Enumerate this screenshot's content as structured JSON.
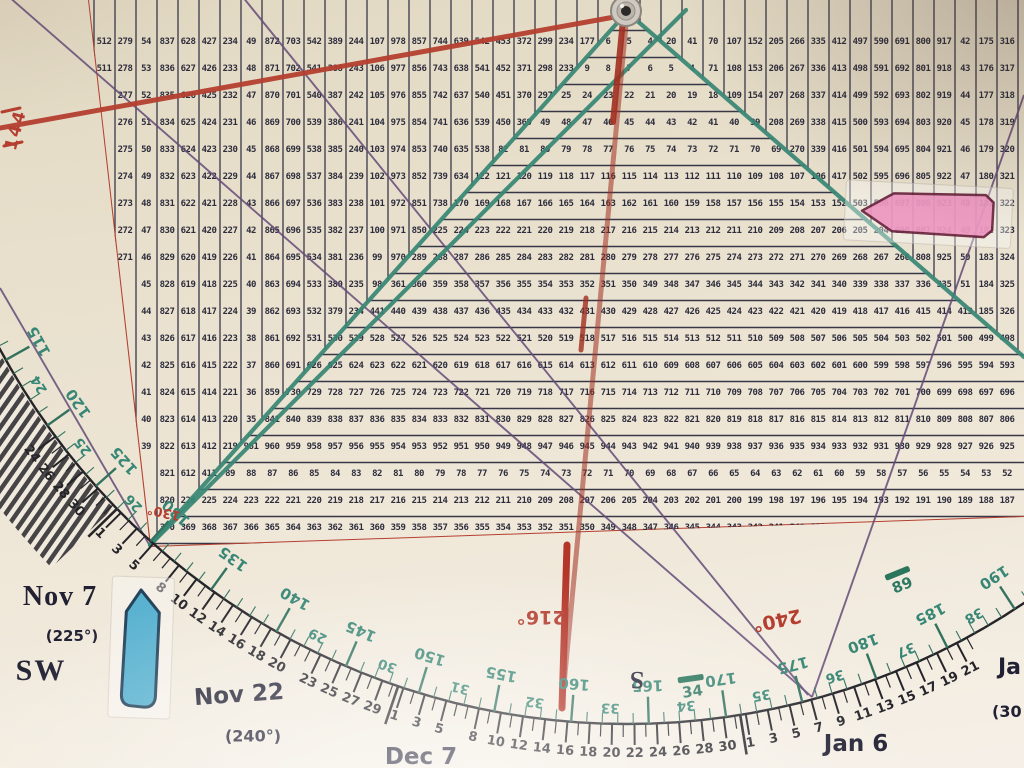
{
  "colors": {
    "ink": "#202134",
    "grid_line": "#2c2c40",
    "red": "#b23526",
    "dark_red": "#9c2316",
    "green": "#2c8170",
    "green_tick": "#256b58",
    "purple": "#5a4173",
    "navy": "#14142a",
    "pink": "#ee8fc0",
    "pink_border": "#5d1230",
    "blue": "#4fb0d2",
    "blue_border": "#173a55",
    "arc_ink": "#17171f"
  },
  "grid": {
    "left_column_tops": [
      512,
      279,
      54,
      837,
      628,
      427,
      234,
      49,
      872,
      703,
      542,
      389,
      244,
      107,
      978,
      857,
      744,
      639,
      542,
      453,
      372,
      299,
      234,
      177,
      128,
      87
    ],
    "right_column_tops": [
      2,
      7,
      20,
      41,
      70,
      107,
      152,
      205,
      266,
      335,
      412,
      497,
      590,
      691,
      800,
      917,
      42,
      175,
      316,
      465
    ],
    "triangle_row_maxes": [
      6,
      10,
      26,
      50,
      82,
      122,
      170,
      226,
      290,
      362,
      442,
      530,
      626,
      730,
      842,
      962,
      90,
      226,
      370,
      522
    ]
  },
  "labels": {
    "nov7": "Nov 7",
    "deg225": "(225°)",
    "sw": "SW",
    "nov22": "Nov 22",
    "deg240": "(240°)",
    "dec7": "Dec 7",
    "jan6": "Jan 6",
    "jan_partial": "Ja",
    "deg300_partial": "(30",
    "south": "S",
    "red_216": "216°",
    "red_240": "240°",
    "red_144": "144",
    "red_130": "130°",
    "marker_34": "34",
    "marker_89": "89"
  },
  "arc": {
    "black_day_labels": [
      [
        -8,
        "24"
      ],
      [
        -6,
        "26"
      ],
      [
        -4,
        "28"
      ],
      [
        -2,
        "30"
      ],
      [
        1,
        "1"
      ],
      [
        3,
        "3"
      ],
      [
        5,
        "5"
      ],
      [
        8,
        "8"
      ],
      [
        10,
        "10"
      ],
      [
        12,
        "12"
      ],
      [
        14,
        "14"
      ],
      [
        16,
        "16"
      ],
      [
        18,
        "18"
      ],
      [
        20,
        "20"
      ],
      [
        23,
        "23"
      ],
      [
        25,
        "25"
      ],
      [
        27,
        "27"
      ],
      [
        29,
        "29"
      ],
      [
        31,
        "1"
      ],
      [
        33,
        "3"
      ],
      [
        35,
        "5"
      ],
      [
        38,
        "8"
      ],
      [
        40,
        "10"
      ],
      [
        42,
        "12"
      ],
      [
        44,
        "14"
      ],
      [
        46,
        "16"
      ],
      [
        48,
        "18"
      ],
      [
        50,
        "20"
      ],
      [
        52,
        "22"
      ],
      [
        54,
        "24"
      ],
      [
        56,
        "26"
      ],
      [
        58,
        "28"
      ],
      [
        60,
        "30"
      ],
      [
        62,
        "1"
      ],
      [
        64,
        "3"
      ],
      [
        66,
        "5"
      ],
      [
        68,
        "7"
      ],
      [
        70,
        "9"
      ],
      [
        72,
        "11"
      ],
      [
        74,
        "13"
      ],
      [
        76,
        "15"
      ],
      [
        78,
        "17"
      ],
      [
        80,
        "19"
      ],
      [
        82,
        "21"
      ]
    ],
    "month_boundary_days": [
      0.5,
      30.5,
      61.5
    ],
    "green_big_labels": [
      115,
      120,
      125,
      130,
      135,
      140,
      145,
      150,
      155,
      160,
      165,
      170,
      175,
      180,
      185,
      190
    ],
    "green_small_labels": [
      [
        24,
        117.5
      ],
      [
        25,
        122.5
      ],
      [
        26,
        127.5
      ],
      [
        29,
        142.5
      ],
      [
        30,
        147.5
      ],
      [
        31,
        152.5
      ],
      [
        32,
        157.5
      ],
      [
        33,
        162.5
      ],
      [
        34,
        167.5
      ],
      [
        35,
        172.5
      ],
      [
        36,
        177.5
      ],
      [
        37,
        182.5
      ],
      [
        38,
        187.5
      ]
    ]
  },
  "layout": {
    "arc_center": [
      627,
      12
    ],
    "arc_radius": 712,
    "date_scale": {
      "anchor_day": 8,
      "anchor_theta": 129,
      "deg_per_day": 0.9
    },
    "green_scale": {
      "anchor_value": 170,
      "anchor_theta": 82,
      "deg_per_unit": 1.25
    },
    "grid_geom": {
      "col_w": 21,
      "row_h": 27,
      "first_cx": 104,
      "first_cy": 44,
      "apex": [
        627,
        12
      ],
      "left_slope": 0.895,
      "right_slope": 1.157,
      "left_border": [
        88,
        0,
        150,
        546
      ],
      "bottom_border": [
        150,
        547,
        1024,
        517
      ]
    },
    "purple_lines": [
      [
        8,
        -4,
        812,
        697
      ],
      [
        242,
        -4,
        808,
        695
      ],
      [
        0,
        288,
        150,
        546
      ],
      [
        812,
        697,
        1024,
        95
      ]
    ],
    "green_lines": [
      [
        627,
        12,
        150,
        545
      ],
      [
        627,
        12,
        1024,
        357
      ],
      [
        150,
        545,
        686,
        10
      ]
    ],
    "red_arm": [
      0,
      128,
      620,
      16
    ],
    "red_center": [
      627,
      14,
      562,
      706
    ],
    "stripe_wedge": {
      "t1": 136,
      "t2": 151,
      "r1": 714,
      "r2": 800
    }
  }
}
